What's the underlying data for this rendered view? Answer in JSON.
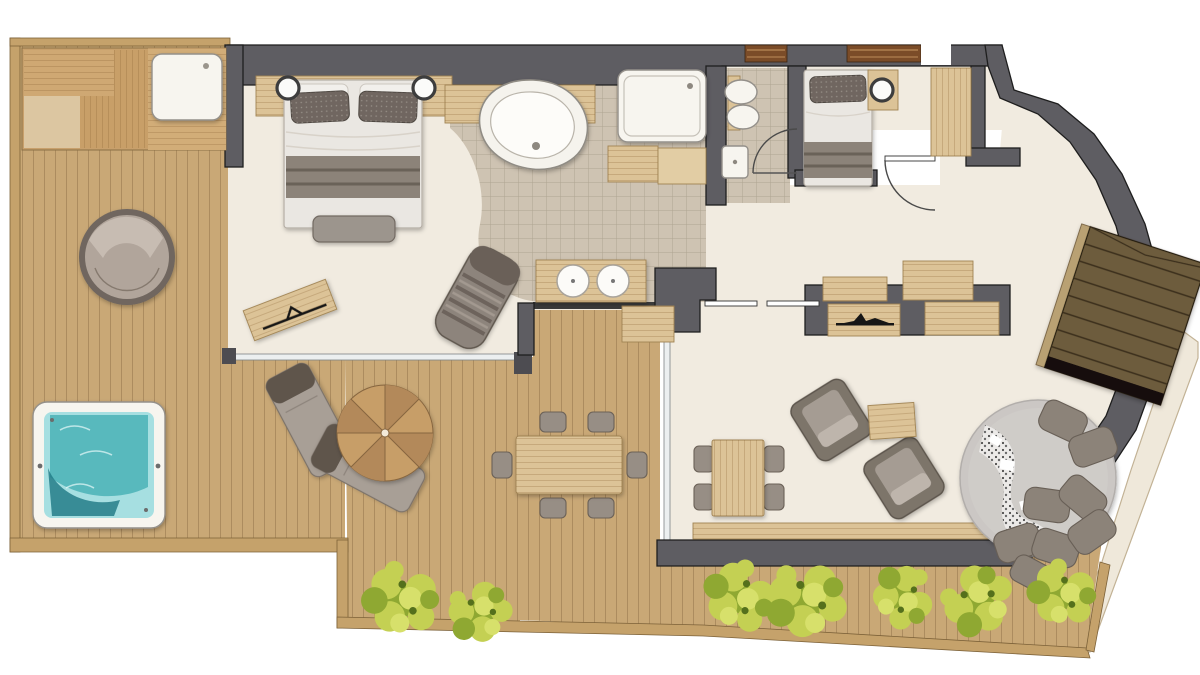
{
  "page": {
    "background": "#ffffff",
    "kind": "apartment-floor-plan-illustration",
    "visible_text": []
  },
  "palette": {
    "wall": "#5e5d62",
    "wallStroke": "#1e1e1e",
    "deck": "#c9a876",
    "fascia": "#c5a26b",
    "fasciaStroke": "#7c6138",
    "floor": "#f1ebe0",
    "tile": "#cec3b2",
    "wood": "#dcc397",
    "woodStroke": "#a08353",
    "fixture": "#f7f5ef",
    "fixtureStroke": "#94908a",
    "water": "#58b9bd",
    "waterDark": "#247e88",
    "waterLight": "#a6dfe1",
    "plant": "#c4d053",
    "plantDark": "#8fa832",
    "stairs": "#6d5c3c",
    "stairsLine": "#3a2f1c",
    "stringer": "#b9a173",
    "umbrella": "#c79e68",
    "umbrellaAlt": "#b3895a",
    "umbrellaLine": "#87663f",
    "fabric": "#978e85",
    "fabricDark": "#6b6157",
    "fabricLight": "#b9b0a7",
    "rug": "#cbc7c4",
    "rugEdge": "#b2aeab",
    "pillow": "#8c8379",
    "pillowDark": "#685f56",
    "bedWhite": "#eae7e2",
    "pillowPattern": "#6f6660",
    "arc": "#4a4a4a",
    "windowWood": "#7b4c28",
    "windowWoodLight": "#b08050",
    "sculpture": "#161616",
    "wedge": "#efe8da",
    "wedgeEdge": "#c2b295",
    "glass": "#eceff0",
    "post": "#4d4c51"
  },
  "rooms": [
    {
      "id": "terrace",
      "label": "wrap-around terrace",
      "items": [
        "sauna-benches",
        "outdoor-shower-tray",
        "hot-tub",
        "round-daybed",
        "parasol",
        "sun-lounger-1",
        "sun-lounger-2",
        "outdoor-dining-table",
        "outdoor-chairs-6",
        "storage-box",
        "shrub-planters-7"
      ]
    },
    {
      "id": "bedroom-1",
      "label": "master bedroom",
      "items": [
        "double-bed",
        "headboard-shelf",
        "bedside-lamp-2",
        "foot-bench",
        "valet-bench",
        "chaise-longue",
        "glass-wall"
      ]
    },
    {
      "id": "bathroom",
      "label": "open bathroom",
      "items": [
        "freeform-bathtub",
        "walk-in-shower",
        "double-vanity",
        "wash-basin-2",
        "cabinet-2"
      ]
    },
    {
      "id": "wc",
      "label": "wc",
      "items": [
        "toilet",
        "bidet",
        "hand-basin",
        "door-arc"
      ]
    },
    {
      "id": "bedroom-2",
      "label": "second bedroom",
      "items": [
        "bed",
        "bedside-lamp",
        "wardrobe",
        "sliding-door"
      ]
    },
    {
      "id": "hallway",
      "label": "hallway / entry",
      "items": [
        "entry-door-arc",
        "sliding-door-dashes",
        "wall-cabinets-4",
        "console",
        "mountain-sculpture"
      ]
    },
    {
      "id": "living-room",
      "label": "living room",
      "items": [
        "square-dining-table",
        "dining-chairs-4",
        "armchair-1",
        "armchair-2",
        "side-table",
        "window-bench",
        "round-rug",
        "cushion-pile",
        "speckled-throw"
      ]
    },
    {
      "id": "staircase",
      "label": "staircase",
      "items": [
        "wood-steps",
        "stringer"
      ]
    }
  ]
}
